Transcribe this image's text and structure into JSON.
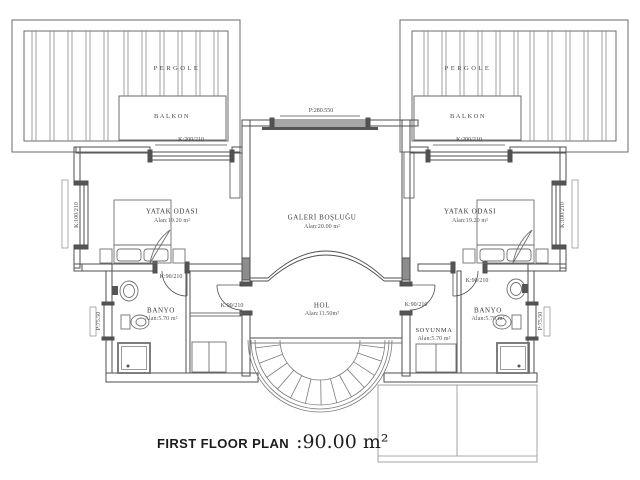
{
  "title": {
    "plan": "FIRST FLOOR PLAN",
    "area": ":90.00 m²"
  },
  "pergola_left": {
    "name": "PERGOLE",
    "balkon": "BALKON"
  },
  "pergola_right": {
    "name": "PERGOLE",
    "balkon": "BALKON"
  },
  "rooms": {
    "bedroom_left": {
      "name": "YATAK ODASI",
      "area": "Alan:19.20 m²"
    },
    "bedroom_right": {
      "name": "YATAK ODASI",
      "area": "Alan:19.20 m²"
    },
    "gallery": {
      "name": "GALERİ BOŞLUĞU",
      "area": "Alan:20.00 m²"
    },
    "hall": {
      "name": "HOL",
      "area": "Alan:11.50m²"
    },
    "bathroom_left": {
      "name": "BANYO",
      "area": "Alan:5.70 m²"
    },
    "bathroom_right": {
      "name": "BANYO",
      "area": "Alan:5.70 m²"
    },
    "dressing": {
      "name": "SOYUNMA",
      "area": "Alan:5.70 m²"
    }
  },
  "openings": {
    "window_top_left": "K:200/210",
    "window_top_right": "K:200/210",
    "window_side_left": "K:100/210",
    "window_side_right": "K:100/210",
    "window_gallery": "P:280.550",
    "window_bath_left": "P:75.50",
    "window_bath_right": "P:75.50",
    "door_bedroom_left": "K:90/210",
    "door_bedroom_right": "K:90/210",
    "door_hall_left": "K:90/210",
    "door_hall_right": "K:90/210"
  },
  "colors": {
    "wall_line": "#4f4f4f",
    "detail_line": "#7a7a7a",
    "text": "#3c3c3c",
    "background": "#ffffff"
  }
}
